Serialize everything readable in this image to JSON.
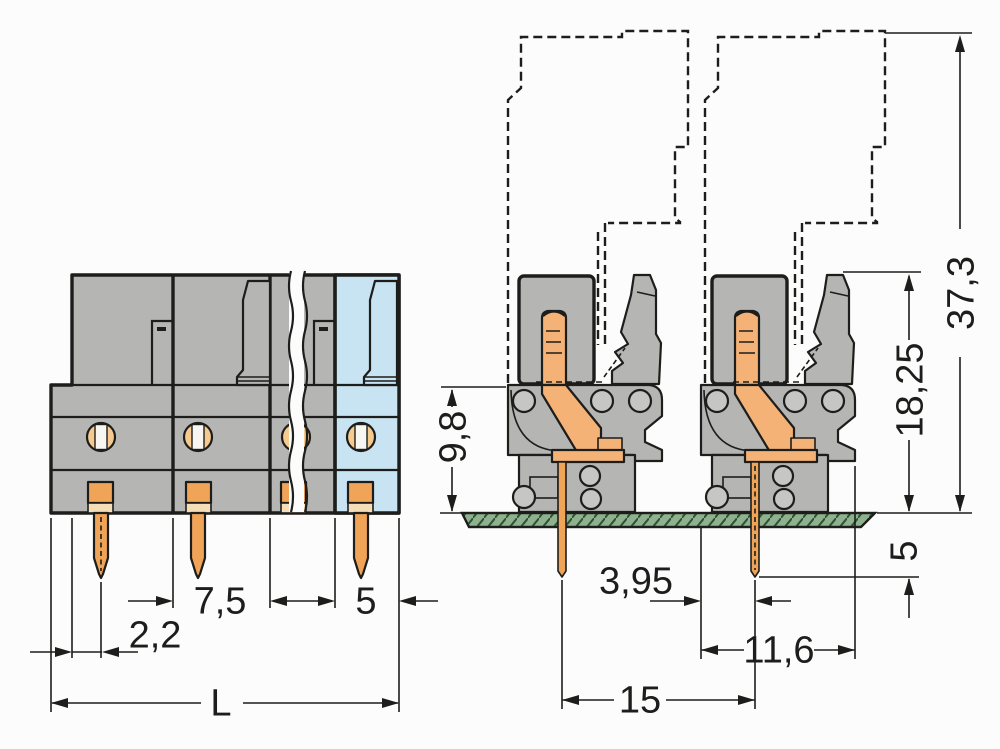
{
  "front_view": {
    "labels": {
      "pitch": "7,5",
      "end_unit_width": "5",
      "pin_offset": "2,2",
      "total_length": "L"
    }
  },
  "side_view": {
    "labels": {
      "overall_height": "37,3",
      "height_above_board": "18,25",
      "housing_height": "9,8",
      "pin_below_board": "5",
      "pin_to_edge": "3,95",
      "housing_depth": "11,6",
      "contact_spacing": "15"
    }
  },
  "colors": {
    "housing-gray": "#b5b5b3",
    "housing-blue": "#c8e3f1",
    "contact-orange": "#f4b276",
    "accent-orange": "#f0a458",
    "crescent-orange": "#f6c98f",
    "pale-strip": "#f5ddb8",
    "pcb-green": "#8db28d",
    "pcb-hatch": "#2f5135",
    "line": "#1d1d1b",
    "bg": "#fcfcfc"
  }
}
